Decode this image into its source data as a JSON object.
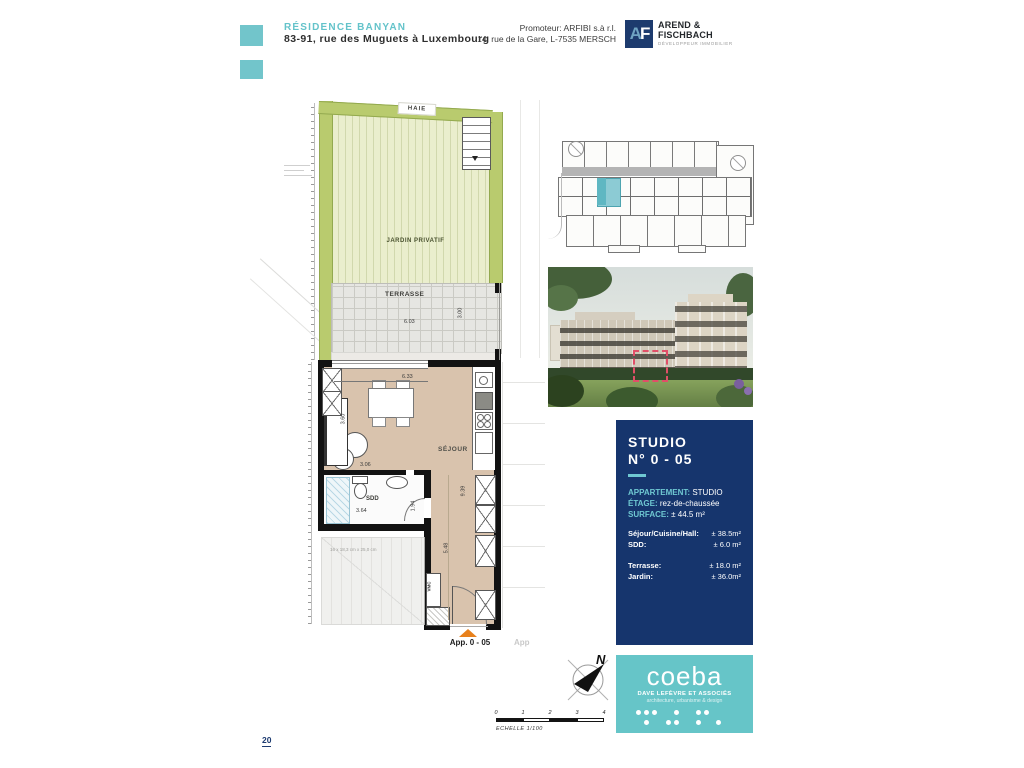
{
  "header": {
    "project_name": "RÉSIDENCE BANYAN",
    "address": "83-91, rue des Muguets à Luxembourg",
    "promoter_line1": "Promoteur: ARFIBI s.à r.l.",
    "promoter_line2": "14, rue de la Gare, L-7535 MERSCH",
    "developer": {
      "initial_a": "A",
      "initial_f": "F",
      "name_line1": "AREND &",
      "name_line2": "FISCHBACH",
      "tagline": "DÉVELOPPEUR IMMOBILIER"
    }
  },
  "plan": {
    "labels": {
      "hedge": "HAIE",
      "garden": "JARDIN PRIVATIF",
      "terrace": "TERRASSE",
      "living": "SÉJOUR",
      "bathroom": "SDD",
      "vent": "VMC",
      "apartment": "App. 0 - 05",
      "adjacent": "App",
      "stair_note": "16 x 18,3 cm x 25,0 cm"
    },
    "dimensions": {
      "terrace_width": "6.03",
      "terrace_depth": "3.00",
      "living_width": "6.33",
      "living_depth": "3.60",
      "sofa_width": "3.06",
      "corridor_depth": "9.39",
      "hall_depth": "5.48",
      "bathroom_width": "3.64",
      "bathroom_depth": "1.94"
    }
  },
  "info_panel": {
    "title_line1": "STUDIO",
    "title_line2": "N° 0 - 05",
    "specs": [
      {
        "label": "APPARTEMENT:",
        "value": "STUDIO"
      },
      {
        "label": "ÉTAGE:",
        "value": "rez-de-chaussée"
      },
      {
        "label": "SURFACE:",
        "value": "± 44.5 m²"
      }
    ],
    "rooms": [
      {
        "label": "Séjour/Cuisine/Hall:",
        "value": "± 38.5m²"
      },
      {
        "label": "SDD:",
        "value": "± 6.0 m²"
      }
    ],
    "outdoor": [
      {
        "label": "Terrasse:",
        "value": "± 18.0 m²"
      },
      {
        "label": "Jardin:",
        "value": "± 36.0m²"
      }
    ]
  },
  "architect": {
    "name": "coeba",
    "subtitle": "DAVE LEFÈVRE ET ASSOCIÉS",
    "tagline": "architecture, urbanisme & design"
  },
  "compass": {
    "north": "N"
  },
  "scale_bar": {
    "ticks": [
      "0",
      "1",
      "2",
      "3",
      "4"
    ],
    "label": "ECHELLE  1/100"
  },
  "footer": {
    "page_number": "20"
  },
  "colors": {
    "brand_teal": "#66c5c8",
    "panel_navy": "#16356d",
    "panel_label_teal": "#6fc8d2",
    "entrance_orange": "#e8811c",
    "highlight_red": "#e04f68",
    "hedge_green": "#b9cb6e",
    "garden_green": "#eaeecd",
    "floor_beige": "#d9c3ad"
  }
}
